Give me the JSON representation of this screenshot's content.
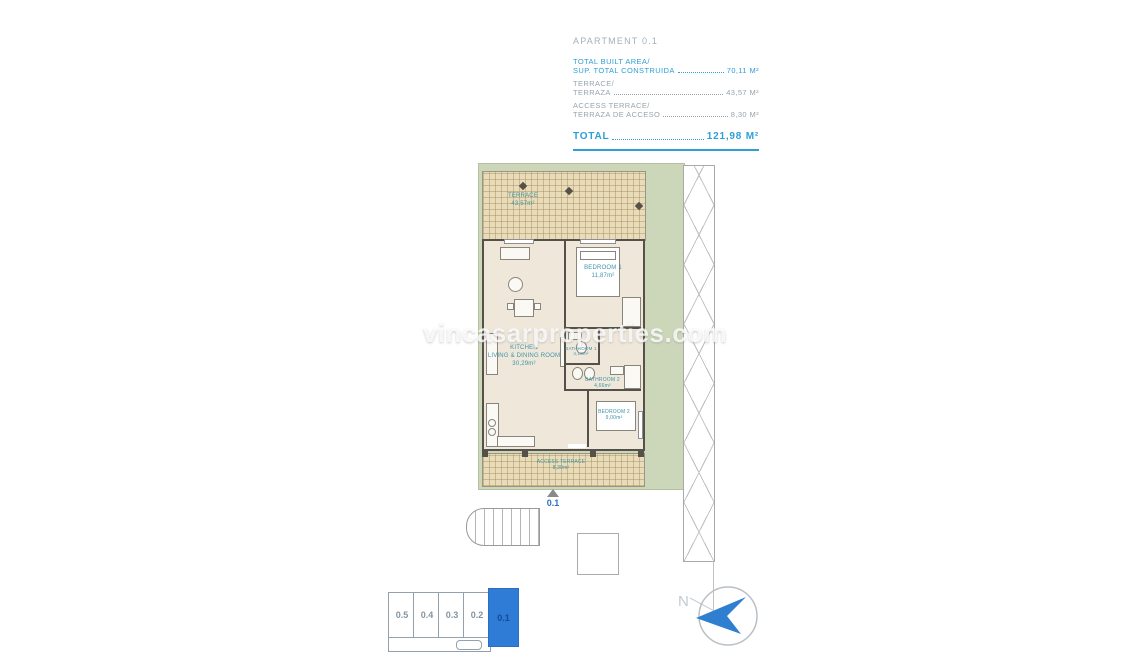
{
  "header": {
    "title": "APARTMENT 0.1",
    "rows": [
      {
        "line1": "TOTAL BUILT AREA/",
        "line2": "SUP. TOTAL CONSTRUIDA",
        "value": "70,11 M²"
      },
      {
        "line1": "TERRACE/",
        "line2": "TERRAZA",
        "value": "43,57 M²"
      },
      {
        "line1": "ACCESS TERRACE/",
        "line2": "TERRAZA DE ACCESO",
        "value": "8,30 M²"
      }
    ],
    "total_label": "TOTAL",
    "total_value": "121,98 M²"
  },
  "plan": {
    "terrace": {
      "name": "TERRACE",
      "area": "43,57m²"
    },
    "bedroom1": {
      "name": "BEDROOM 1",
      "area": "11,87m²"
    },
    "kitchen": {
      "name": "KITCHEN",
      "name2": "LIVING & DINING ROOM",
      "area": "30,29m²"
    },
    "bathroom1": {
      "name": "BATHROOM 1",
      "area": "4,10m²"
    },
    "bathroom2": {
      "name": "BATHROOM 2",
      "area": "4,66m²"
    },
    "bedroom2": {
      "name": "BEDROOM 2",
      "area": "9,00m²"
    },
    "access_terrace": {
      "name": "ACCESS TERRACE",
      "area": "8,30m²"
    },
    "entrance_label": "0.1"
  },
  "keyplan": {
    "units": [
      "0.5",
      "0.4",
      "0.3",
      "0.2",
      "0.1"
    ],
    "selected": "0.1"
  },
  "compass": {
    "letter": "N"
  },
  "watermark": "vincasarproperties.com",
  "colors": {
    "accent_blue": "#2d9fd6",
    "muted_gray": "#96a4ae",
    "selected_unit_blue": "#2e7cd6",
    "lot_green": "#ccd7ba",
    "terrace_tan": "#e9dcba",
    "room_label_teal": "#3f93a8"
  }
}
